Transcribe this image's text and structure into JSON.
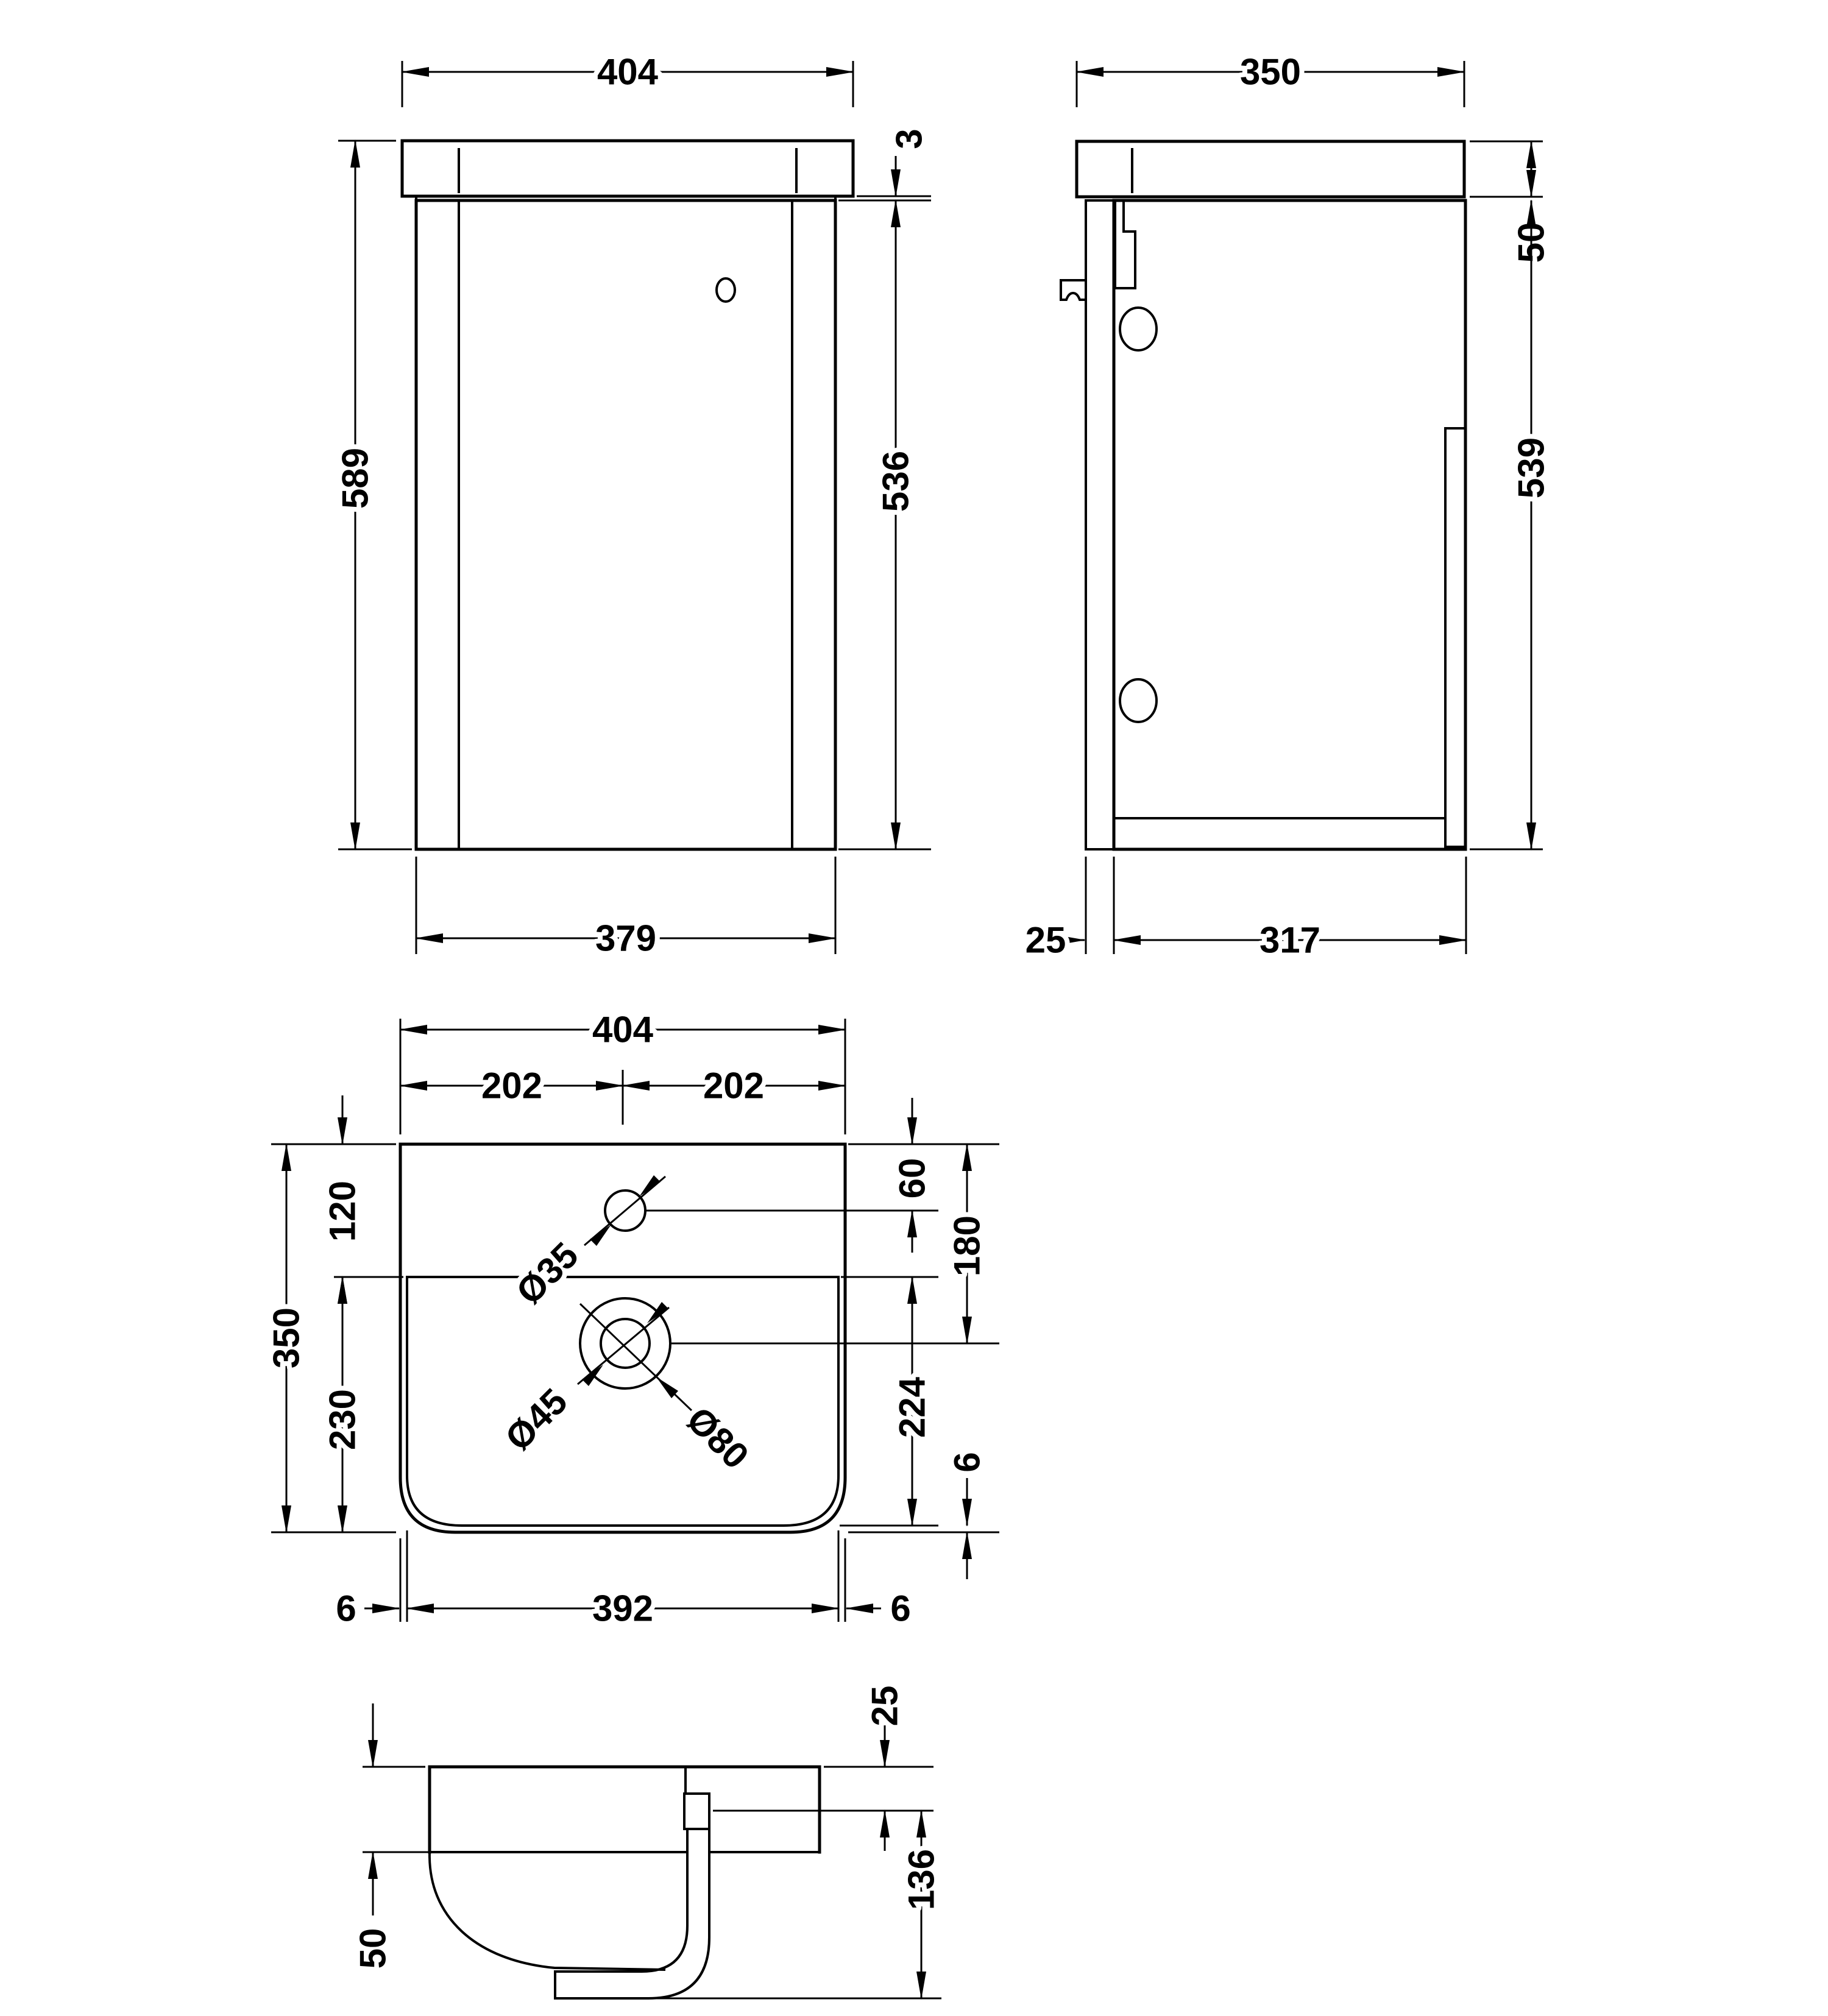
{
  "style": {
    "background": "#ffffff",
    "line_color": "#000000"
  },
  "views": {
    "front": {
      "dims": {
        "top_width": "404",
        "top_edge": "3",
        "overall_height": "589",
        "body_height": "536",
        "bottom_width": "379"
      }
    },
    "side": {
      "dims": {
        "top_depth": "350",
        "worktop_height": "50",
        "body_height": "539",
        "door_thickness": "25",
        "body_depth": "317"
      }
    },
    "plan": {
      "dims": {
        "width": "404",
        "left_half": "202",
        "right_half": "202",
        "depth": "350",
        "back_ledge": "120",
        "front_zone": "230",
        "tap_offset": "60",
        "waste_offset": "180",
        "bowl_depth": "224",
        "rim_left": "6",
        "inner_width": "392",
        "rim_right": "6",
        "rim_front": "6",
        "tap_hole": "Ø35",
        "waste_hole": "Ø45",
        "waste_flange": "Ø80"
      }
    },
    "section": {
      "dims": {
        "front_rim_height": "50",
        "waste_drop": "25",
        "underside_height": "136"
      }
    }
  }
}
